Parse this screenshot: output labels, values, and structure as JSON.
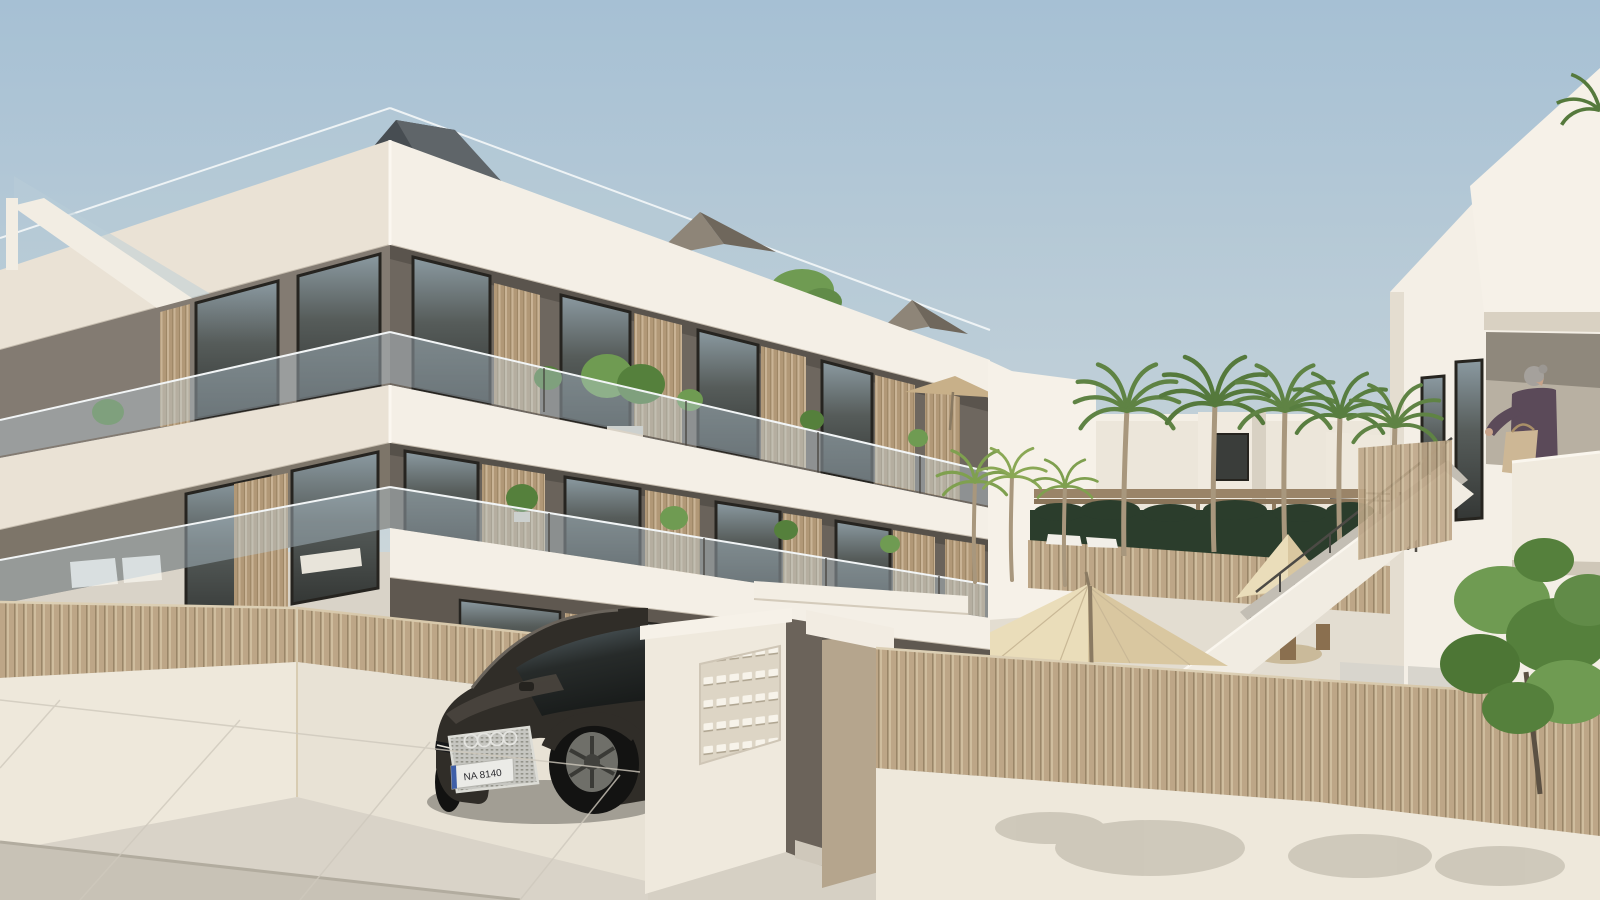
{
  "scene": {
    "type": "architectural-render",
    "car": {
      "license_plate": "NA 8140",
      "brand": "audi-rings",
      "ring_count": 4
    },
    "counts": {
      "building_floors_visible": 3,
      "tall_palm_trees": 5,
      "small_palm_trees": 3,
      "umbrellas": 3
    },
    "colors": {
      "band": "#f4efe6",
      "band_shade": "#eae2d5",
      "wall3": "#6e675f",
      "wall2": "#6a635b",
      "wall1": "#5f5850",
      "wall_left": "#837b72",
      "wall_left2": "#7d7569",
      "white_bright": "#f6f1e8",
      "wall_white": "#eee8db",
      "pave": "#d9d3c8",
      "street": "#c8c2b6",
      "court_ground": "#e3ddd1",
      "car": "#302d28",
      "palm": "#5f8344",
      "palm_dark": "#4a6d33",
      "trunk": "#ab9a80",
      "hedge": "#2b3d2c",
      "umbrella": "#eaddba",
      "umbrella_shade": "#d9c7a0",
      "glassrail": "#b9cdd8",
      "roof_dark": "#474d52",
      "roof_light": "#5f6569",
      "tent": "#8e8578",
      "tent_dark": "#6f675c",
      "person_top": "#5b4a59",
      "bag": "#cdb795",
      "tree": "#55803c",
      "tree_light": "#6f9b52",
      "taupe": "#b5a58d",
      "gap_dark": "#6b635a",
      "steel": "#4c4a45",
      "frame": "#262420"
    }
  }
}
